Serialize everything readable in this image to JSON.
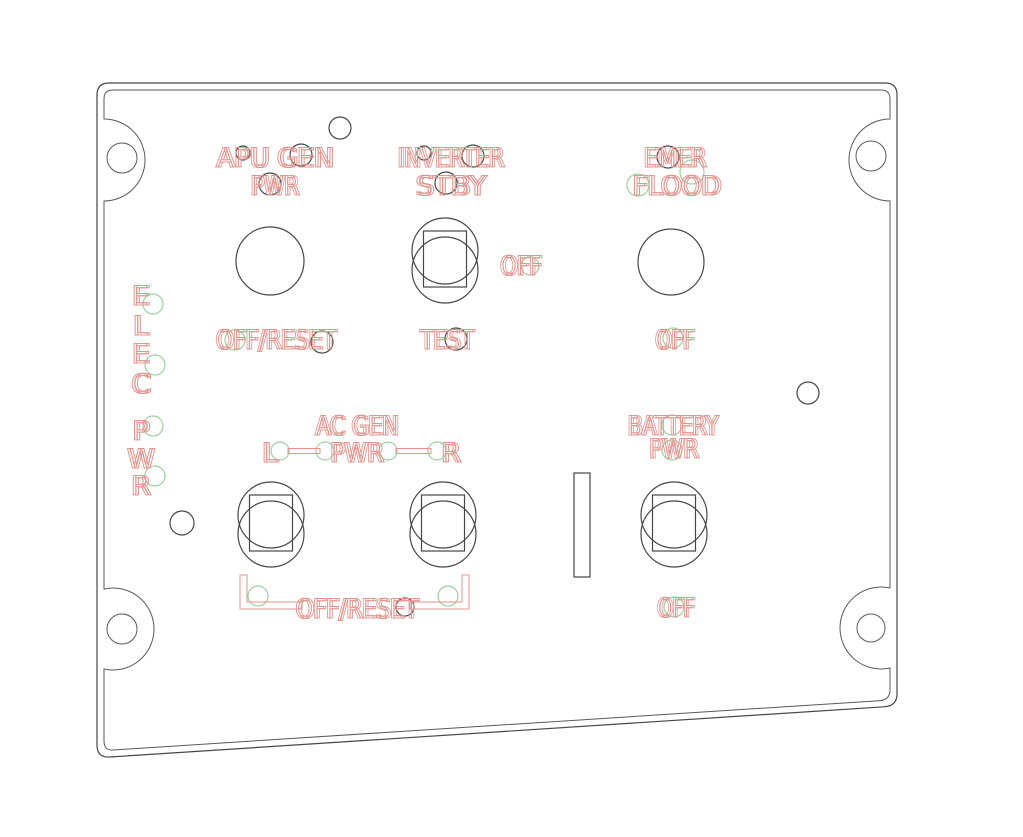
{
  "colors": {
    "cutline": "#474747",
    "engraving": "#e2948e",
    "led_marker": "#9fcfa2",
    "background": "#ffffff"
  },
  "panel": {
    "side_labels": {
      "elec": [
        "E",
        "L",
        "E",
        "C"
      ],
      "pwr": [
        "P",
        "W",
        "R"
      ]
    },
    "apu": {
      "title": "APU GEN",
      "subtitle": "PWR",
      "bottom": "OFF/RESET"
    },
    "inverter": {
      "title": "INVERTER",
      "subtitle": "STBY",
      "right": "OFF",
      "bottom": "TEST"
    },
    "emer": {
      "title": "EMER",
      "subtitle": "FLOOD",
      "bottom": "OFF"
    },
    "ac_gen": {
      "title": "AC GEN",
      "subtitle": "PWR",
      "left": "L",
      "right": "R",
      "bottom": "OFF/RESET"
    },
    "battery": {
      "title": "BATTERY",
      "subtitle": "PWR",
      "bottom": "OFF"
    }
  }
}
